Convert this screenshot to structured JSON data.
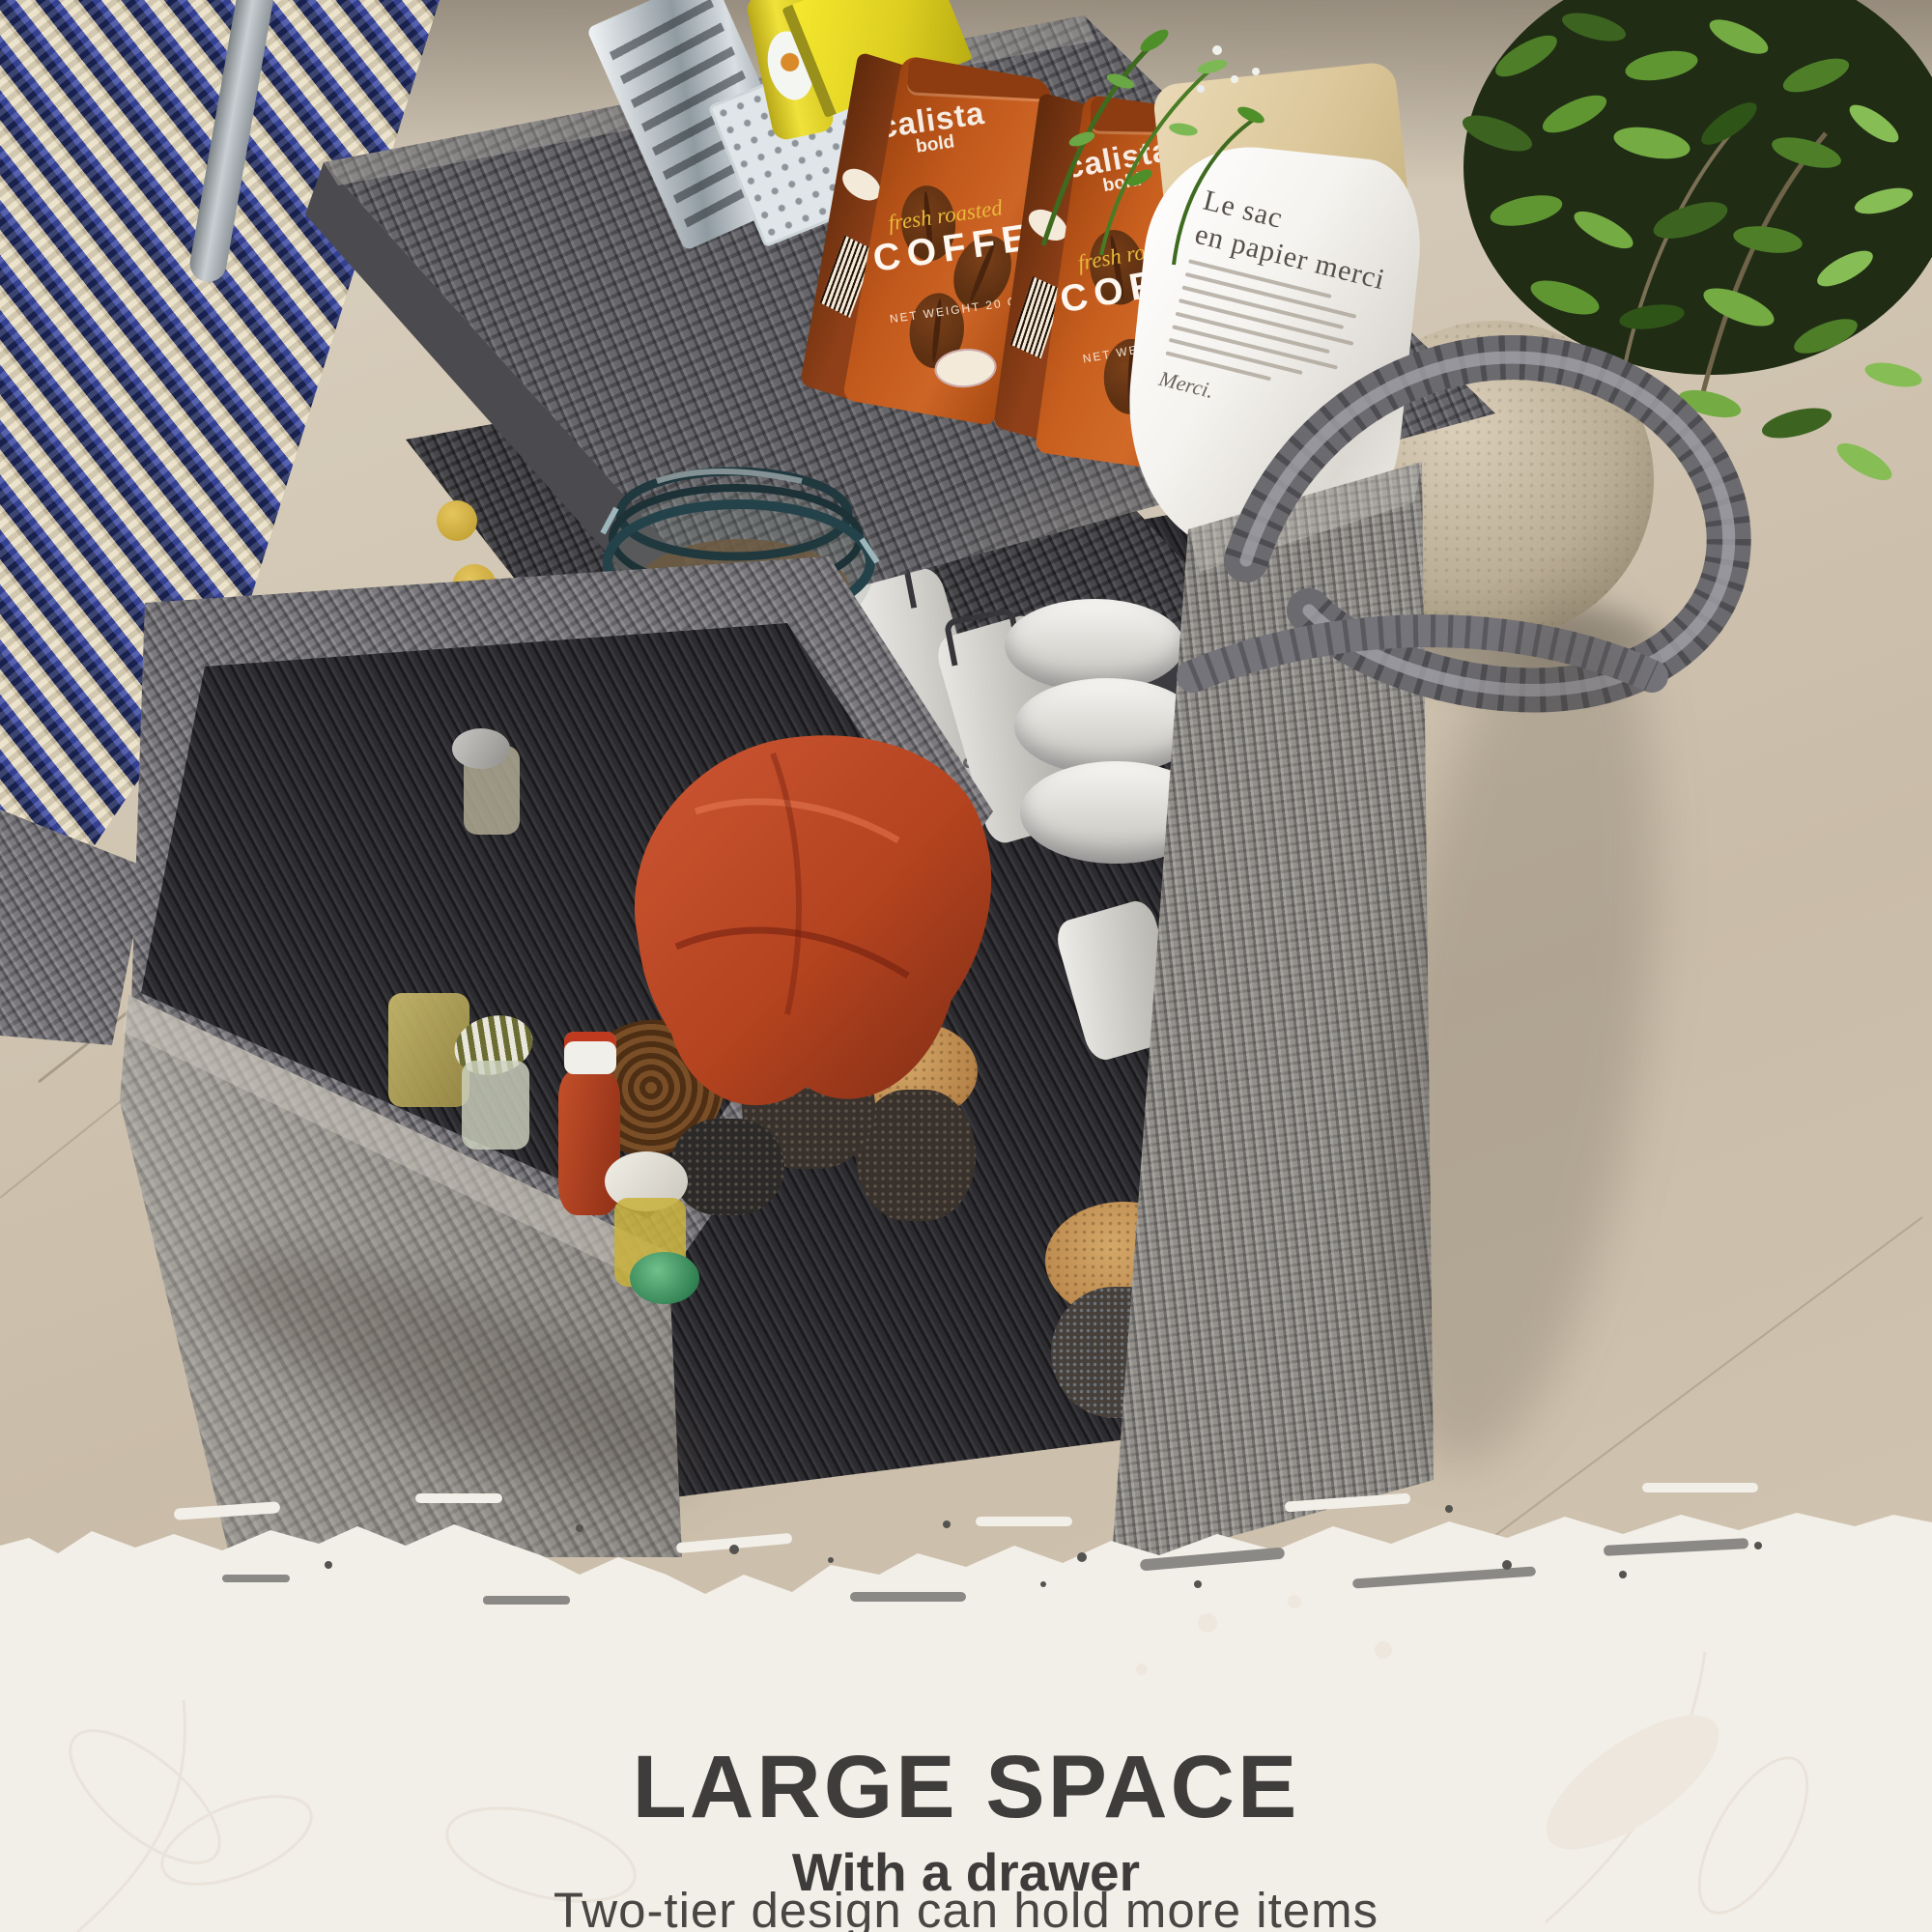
{
  "panel": {
    "title": "LARGE SPACE",
    "subtitle": "With a drawer",
    "description": "Two-tier design can hold more items"
  },
  "scene": {
    "coffee_bag": {
      "brand": "calista",
      "variant": "bold",
      "tagline": "fresh roasted",
      "product": "COFFEE",
      "weight": "NET WEIGHT 20 OZ"
    },
    "paper_bag": {
      "line1": "Le sac",
      "line2": "en papier merci",
      "closing": "Merci."
    },
    "canister_label": "Pepper"
  },
  "colors": {
    "panel_bg": "#f2eee8",
    "heading": "#3e3d3b",
    "coffee_orange": "#c2591c",
    "napkin_red": "#c14a2c",
    "wicker_gray": "#7b797d",
    "rug_blue": "#2c3a8a"
  }
}
